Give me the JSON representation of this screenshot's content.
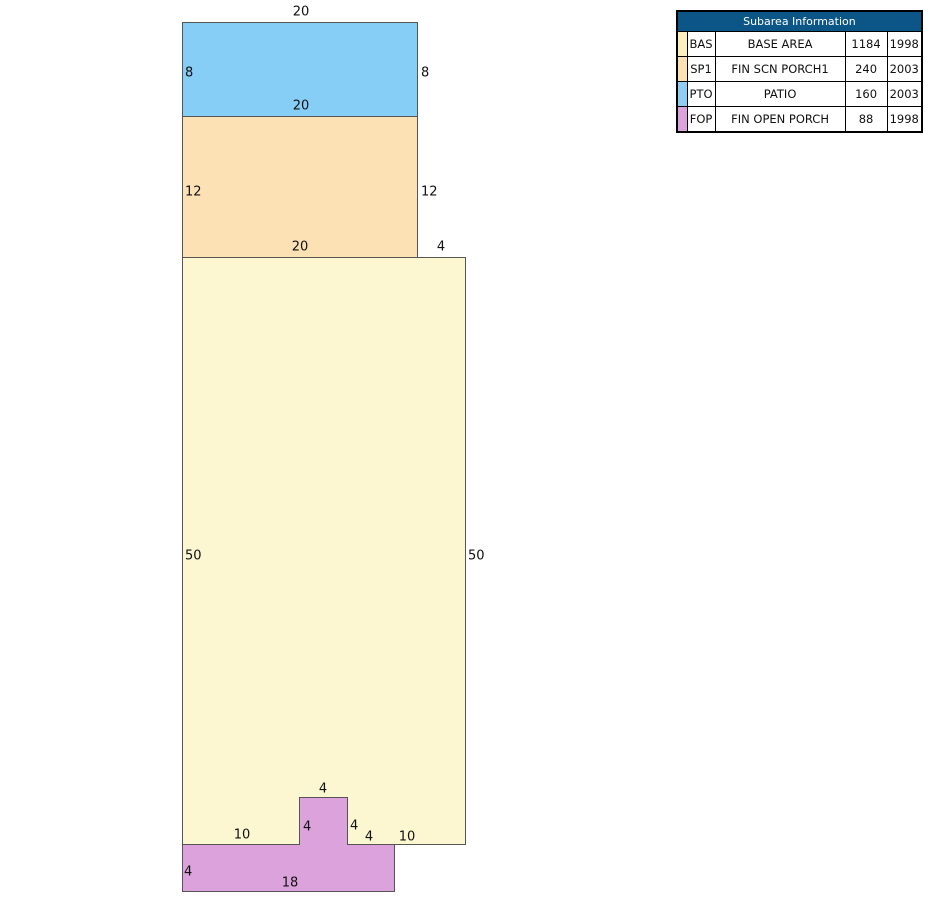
{
  "sketch": {
    "areas": {
      "pto": {
        "code": "PTO",
        "color": "#87CEF7"
      },
      "sp1": {
        "code": "SP1",
        "color": "#FCE1B5"
      },
      "bas": {
        "code": "BAS",
        "color": "#FCF7D1"
      },
      "fop": {
        "code": "FOP",
        "color": "#DCA2DC"
      }
    },
    "dims": {
      "pto_top": "20",
      "pto_left": "8",
      "pto_right": "8",
      "pto_bottom": "20",
      "sp1_left": "12",
      "sp1_right": "12",
      "sp1_bottom": "20",
      "bas_top_right": "4",
      "bas_left": "50",
      "bas_right": "50",
      "bas_bottom_left": "10",
      "fop_bump_top": "4",
      "fop_bump_left": "4",
      "fop_bump_right": "4",
      "bas_bottom_mid": "4",
      "bas_bottom_right": "10",
      "fop_left": "4",
      "fop_bottom": "18"
    }
  },
  "table": {
    "title": "Subarea Information",
    "header_bg": "#0C5687",
    "rows": [
      {
        "color": "#FAEFC1",
        "code": "BAS",
        "description": "BASE AREA",
        "area": "1184",
        "year": "1998"
      },
      {
        "color": "#FCE1B5",
        "code": "SP1",
        "description": "FIN SCN PORCH1",
        "area": "240",
        "year": "2003"
      },
      {
        "color": "#8FCDF2",
        "code": "PTO",
        "description": "PATIO",
        "area": "160",
        "year": "2003"
      },
      {
        "color": "#DCA2DC",
        "code": "FOP",
        "description": "FIN OPEN PORCH",
        "area": "88",
        "year": "1998"
      }
    ]
  }
}
